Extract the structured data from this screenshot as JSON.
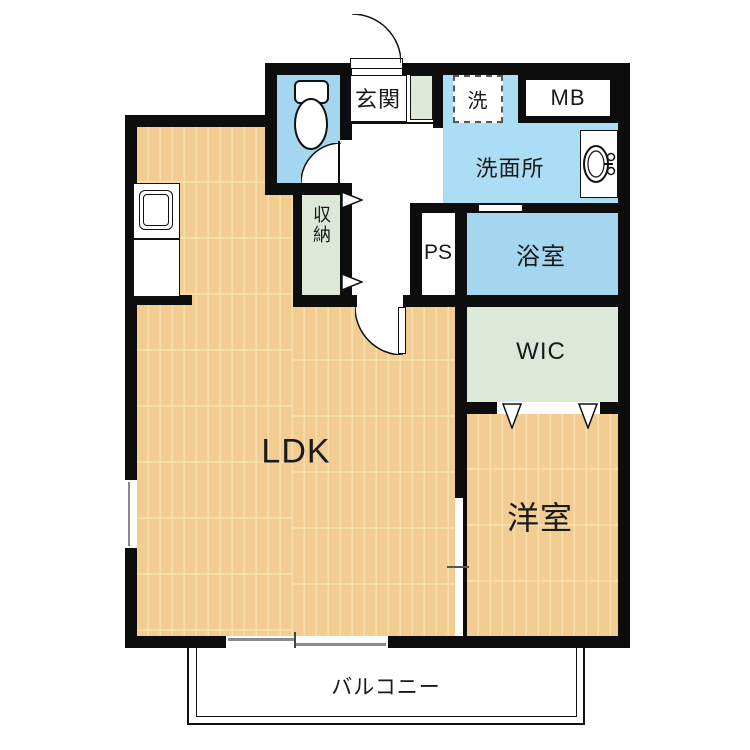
{
  "plan": {
    "rooms": {
      "entrance": "玄関",
      "laundry": "洗",
      "meter_box": "MB",
      "washroom": "洗面所",
      "pipe_space": "PS",
      "bathroom": "浴室",
      "storage": "収納",
      "wic": "WIC",
      "ldk": "LDK",
      "western_room": "洋室",
      "balcony": "バルコニー"
    },
    "colors": {
      "wall": "#0d0d0d",
      "flooring": "#f2cc90",
      "flooring_seam": "#f7e0ab",
      "water_room_blue": "#a4d6ef",
      "washroom_blue": "#abddf4",
      "closet_green": "#dde8d8",
      "window_gray": "#8a8a8a"
    }
  }
}
